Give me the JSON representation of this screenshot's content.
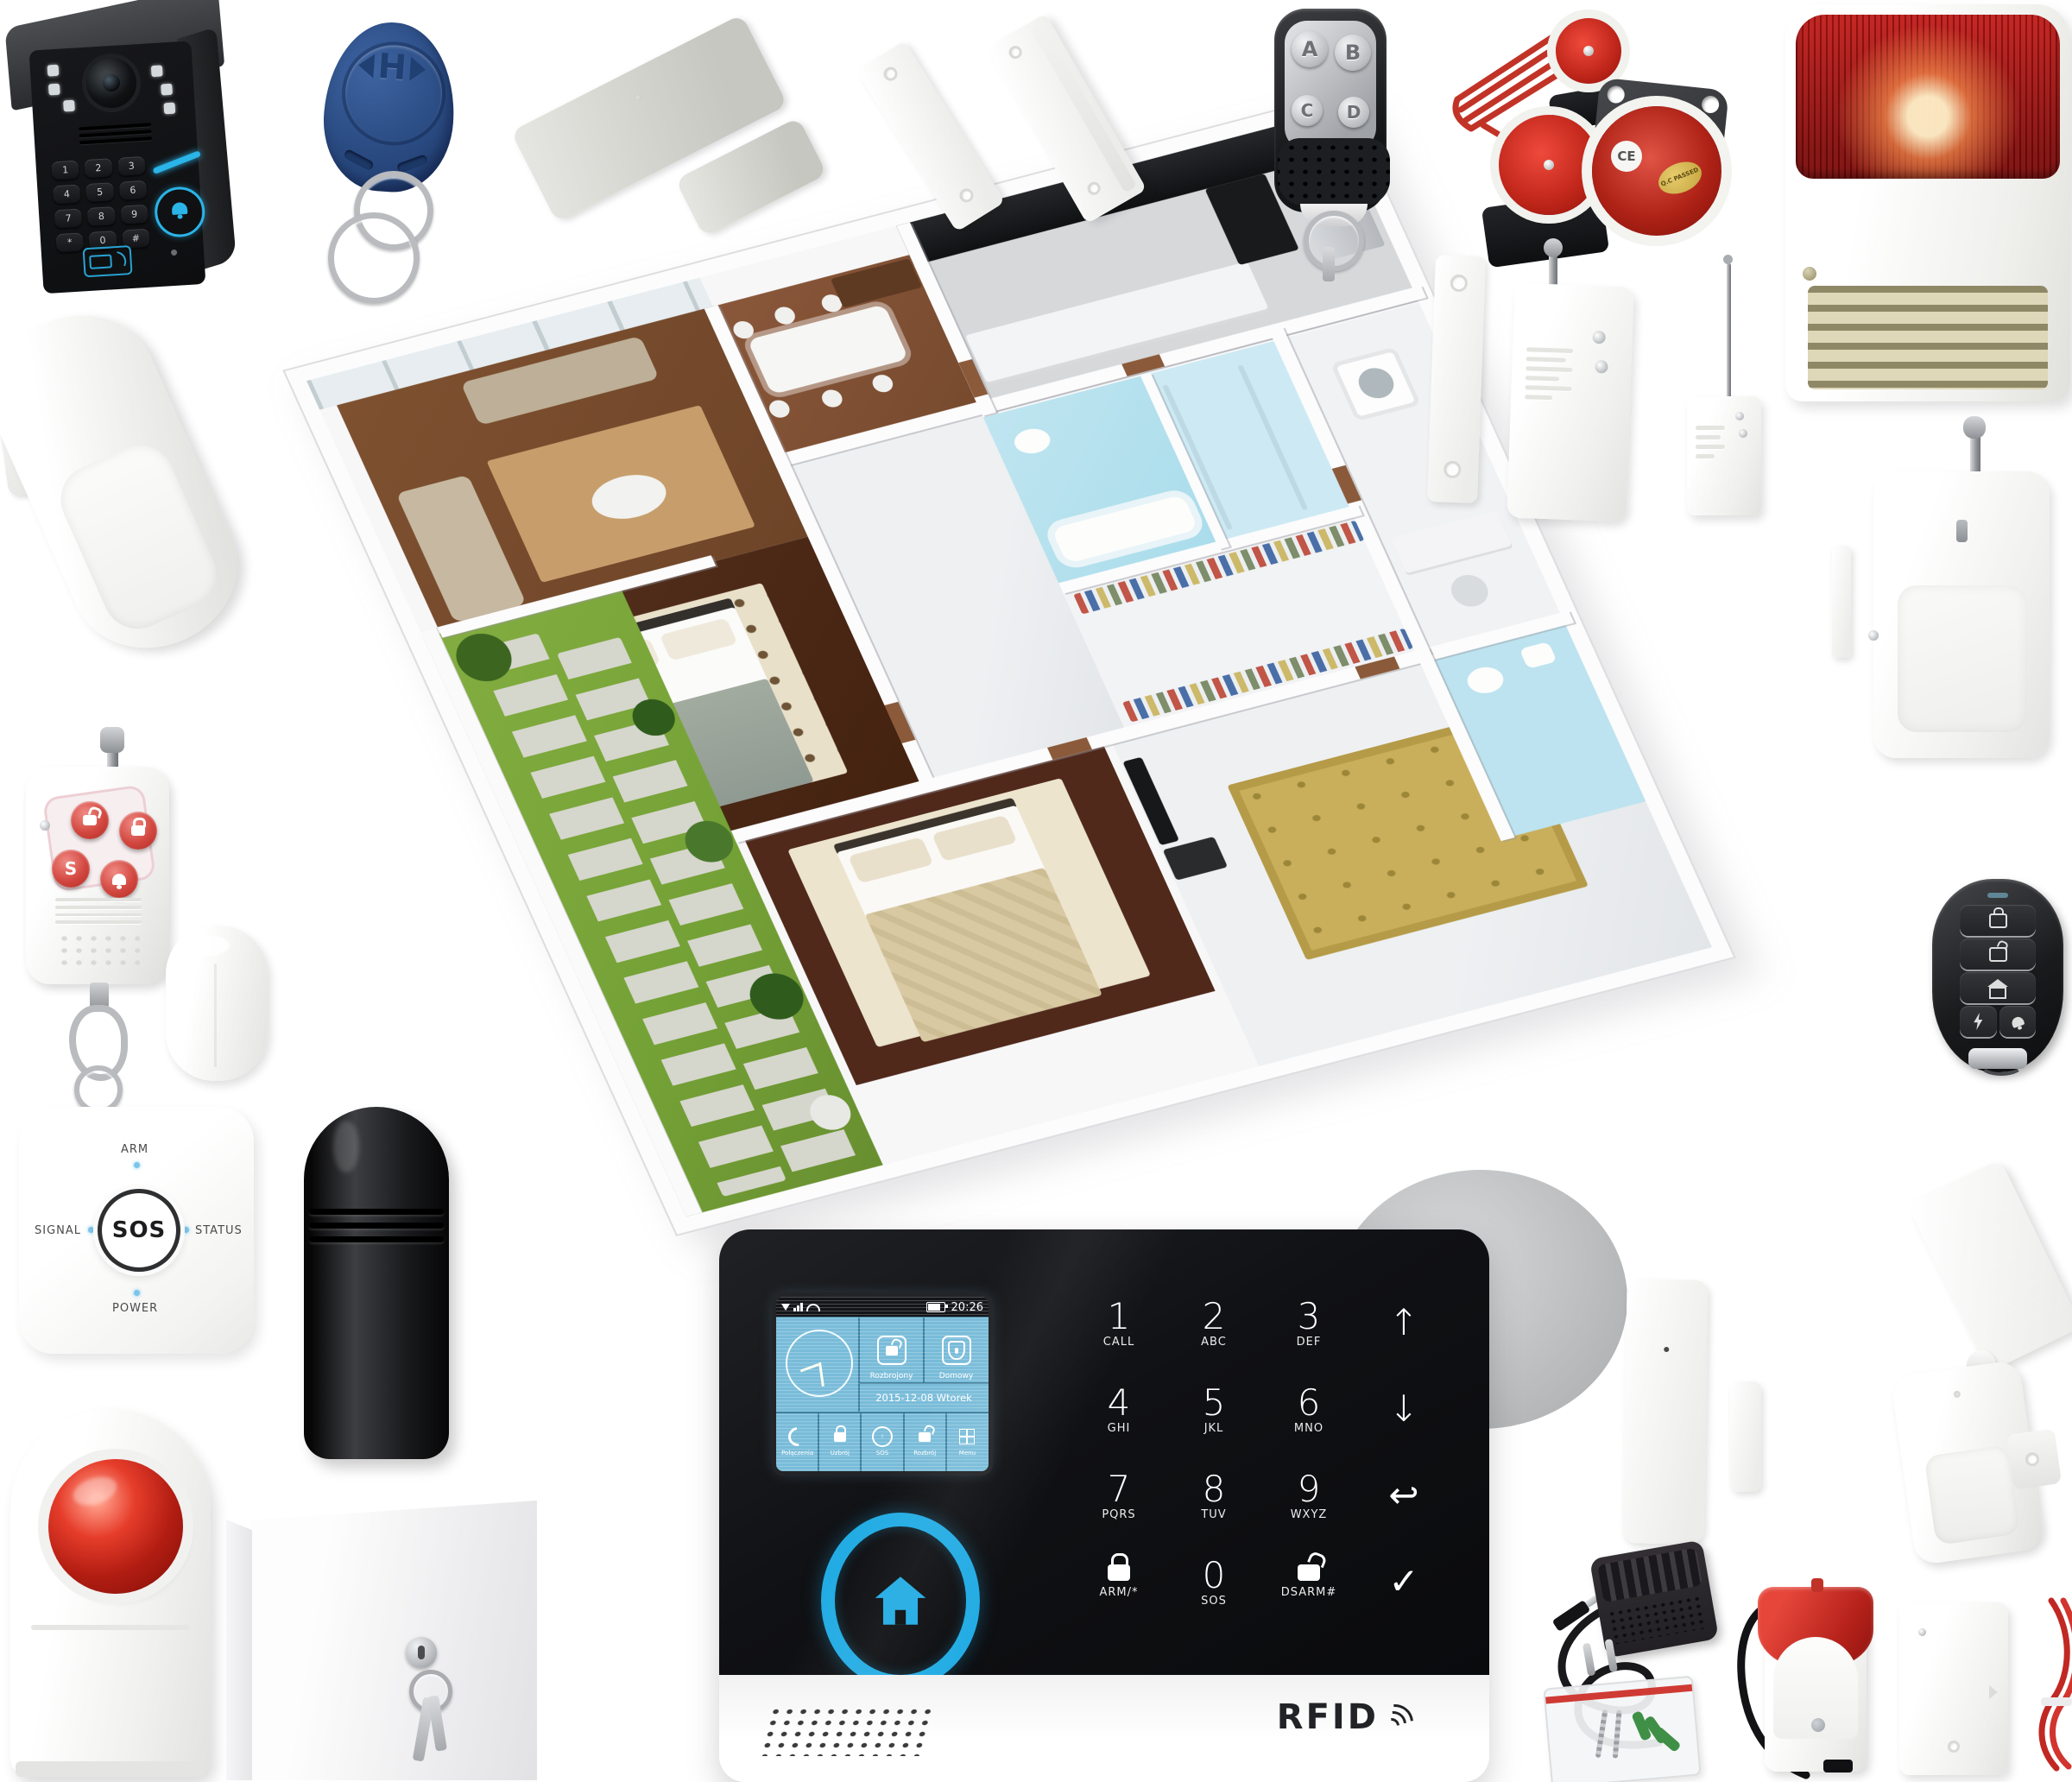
{
  "colors": {
    "accent_blue": "#2ab4e8",
    "siren_red": "#c0231c",
    "fob_blue": "#2e4f86",
    "screen_blue": "#79bcd9"
  },
  "doorbell": {
    "keys": [
      "1",
      "2",
      "3",
      "4",
      "5",
      "6",
      "7",
      "8",
      "9",
      "*",
      "0",
      "#"
    ]
  },
  "rfid_keyfob": {
    "logo": "H"
  },
  "alarm_panel": {
    "status_time": "20:26",
    "date_line": "2015-12-08 Wtorek",
    "tile_disarm": "Rozbrojony",
    "tile_home": "Domowy",
    "menu": [
      "Połączenia",
      "Uzbrój",
      "SOS",
      "Rozbrój",
      "Menu"
    ],
    "keys": [
      {
        "g": "1",
        "s": "CALL"
      },
      {
        "g": "2",
        "s": "ABC"
      },
      {
        "g": "3",
        "s": "DEF"
      },
      {
        "g": "↑",
        "s": ""
      },
      {
        "g": "4",
        "s": "GHI"
      },
      {
        "g": "5",
        "s": "JKL"
      },
      {
        "g": "6",
        "s": "MNO"
      },
      {
        "g": "↓",
        "s": ""
      },
      {
        "g": "7",
        "s": "PQRS"
      },
      {
        "g": "8",
        "s": "TUV"
      },
      {
        "g": "9",
        "s": "WXYZ"
      },
      {
        "g": "↩",
        "s": ""
      },
      {
        "g": "",
        "s": "ARM/*"
      },
      {
        "g": "0",
        "s": "SOS"
      },
      {
        "g": "",
        "s": "DSARM#"
      },
      {
        "g": "✓",
        "s": ""
      }
    ],
    "rfid": "RFID"
  },
  "sos_hub": {
    "arm": "ARM",
    "signal": "SIGNAL",
    "status": "STATUS",
    "power": "POWER",
    "sos": "SOS"
  },
  "remote_abcd": {
    "a": "A",
    "b": "B",
    "c": "C",
    "d": "D"
  },
  "panic_remote": {
    "s": "S"
  },
  "round_siren": {
    "ce": "CE",
    "qc": "Q.C PASSED"
  }
}
